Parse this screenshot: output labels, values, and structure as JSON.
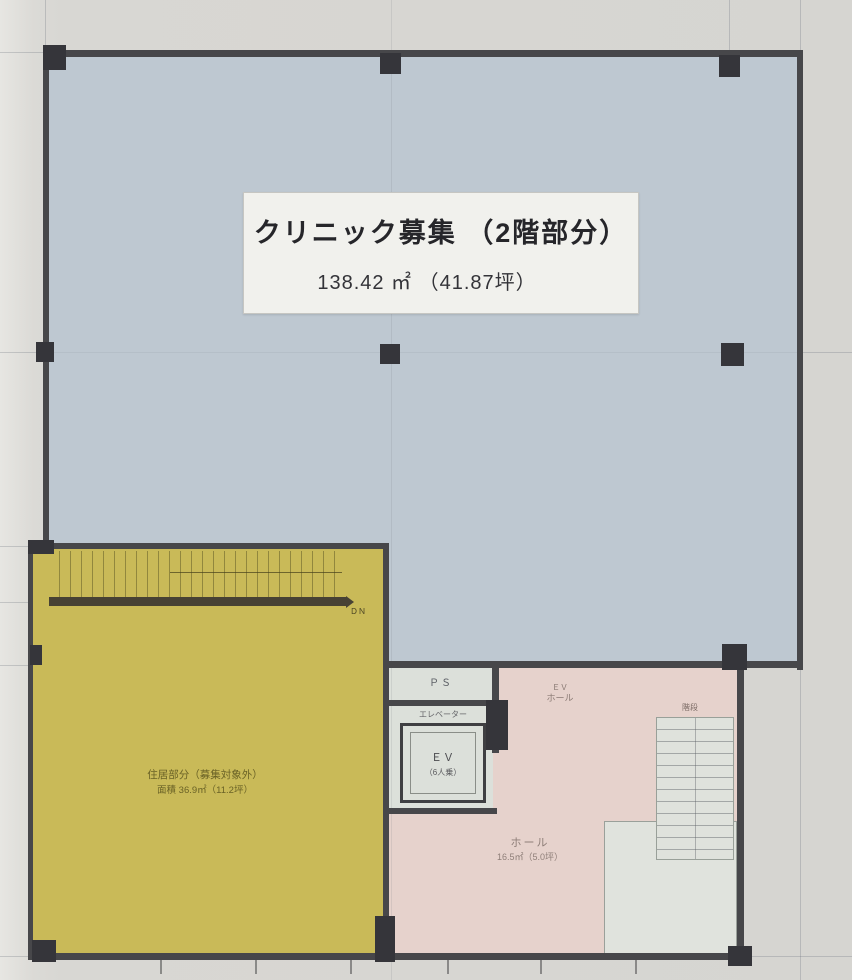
{
  "main_label": {
    "title": "クリニック募集 （2階部分）",
    "area": "138.42 ㎡ （41.87坪）"
  },
  "yellow_area": {
    "line1": "住居部分（募集対象外）",
    "line2": "面積 36.9㎡（11.2坪）",
    "stair_label": "ＤＮ"
  },
  "core": {
    "ps_label": "ＰＳ",
    "elevator_caption": "エレベーター",
    "elevator_label": "ＥＶ",
    "elevator_capacity": "（6人乗）",
    "ev_hall_line1": "ＥＶ",
    "ev_hall_line2": "ホール"
  },
  "hall": {
    "name": "ホール",
    "area": "16.5㎡（5.0坪）"
  },
  "stairs": {
    "label": "階段"
  },
  "colors": {
    "clinic_area": "#bec8d1",
    "yellow_area": "#c9ba58",
    "hall_area": "#e6d2cc",
    "core_area": "#dce0da",
    "wall": "#47474a",
    "label_box": "#f1f1ed"
  }
}
